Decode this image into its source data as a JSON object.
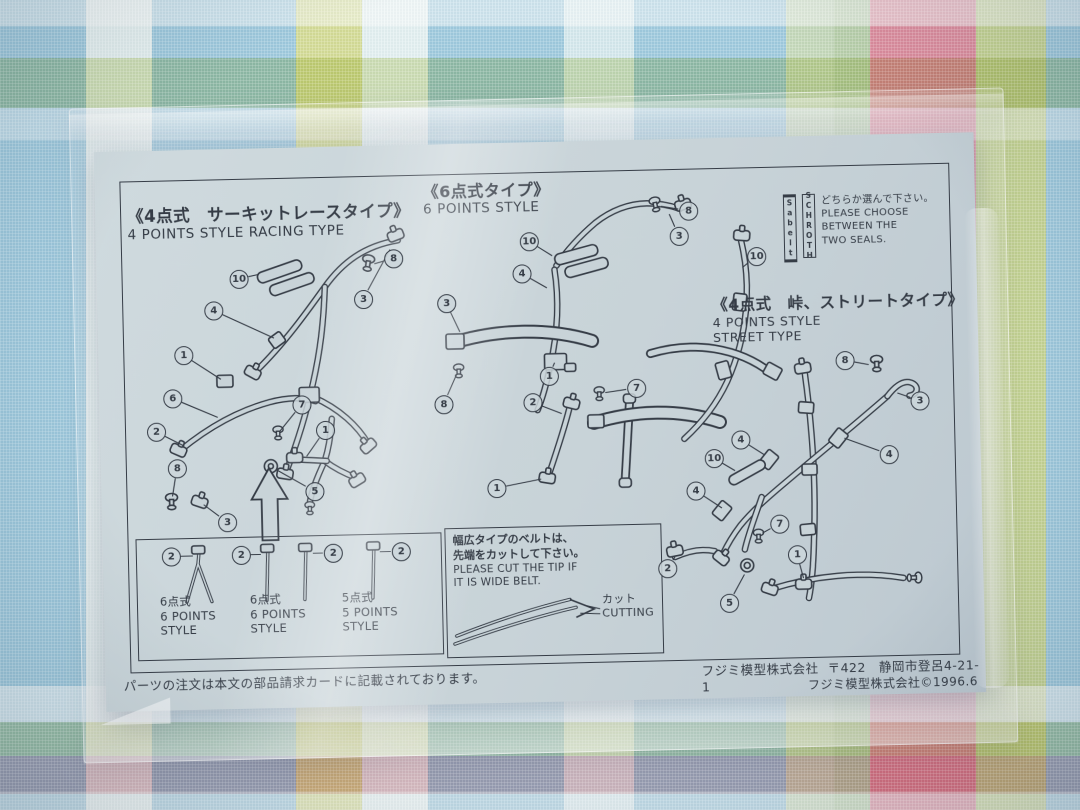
{
  "colors": {
    "fabric_blue": "#9fcade",
    "fabric_pink": "#ee8e9d",
    "fabric_yellow": "#e6df85",
    "fabric_green": "#cdd68e",
    "fabric_white": "#eef4f0",
    "paper": "#c8d3d8",
    "ink": "#353c46"
  },
  "sheet": {
    "sections": {
      "racing": {
        "title_jp": "《4点式　サーキットレースタイプ》",
        "title_en": "4 POINTS STYLE RACING TYPE"
      },
      "six_point": {
        "title_jp": "《6点式タイプ》",
        "title_en": "6 POINTS STYLE"
      },
      "street": {
        "title_jp": "《4点式　峠、ストリートタイプ》",
        "title_en_1": "4 POINTS STYLE",
        "title_en_2": "STREET TYPE"
      },
      "seal_choice": {
        "seal_1": "Sabelt",
        "seal_2": "SCHROTH",
        "jp": "どちらか選んで下さい。",
        "en_1": "PLEASE CHOOSE",
        "en_2": "BETWEEN THE",
        "en_3": "TWO SEALS."
      },
      "belt_ends_box": {
        "items": [
          {
            "jp": "6点式",
            "en_1": "6 POINTS",
            "en_2": "STYLE"
          },
          {
            "jp": "6点式",
            "en_1": "6 POINTS",
            "en_2": "STYLE"
          },
          {
            "jp": "5点式",
            "en_1": "5 POINTS",
            "en_2": "STYLE"
          }
        ]
      },
      "cutting_box": {
        "jp_1": "幅広タイプのベルトは、",
        "jp_2": "先端をカットして下さい。",
        "en_1": "PLEASE CUT THE TIP IF",
        "en_2": "IT IS WIDE BELT.",
        "cut_jp": "カット",
        "cut_en": "CUTTING"
      }
    },
    "footer": {
      "left": "パーツの注文は本文の部品請求カードに記載されております。",
      "company": "フジミ模型株式会社",
      "address": "〒422　静岡市登呂4-21-1",
      "copyright": "フジミ模型株式会社©1996.6"
    }
  },
  "callouts": [
    {
      "n": "10",
      "x": 142,
      "y": 130,
      "tx": 162,
      "ty": 126
    },
    {
      "n": "4",
      "x": 116,
      "y": 161,
      "tx": 176,
      "ty": 190
    },
    {
      "n": "1",
      "x": 85,
      "y": 205,
      "tx": 122,
      "ty": 230
    },
    {
      "n": "6",
      "x": 73,
      "y": 248,
      "tx": 118,
      "ty": 268
    },
    {
      "n": "8",
      "x": 297,
      "y": 113,
      "tx": 278,
      "ty": 118
    },
    {
      "n": "3",
      "x": 266,
      "y": 153,
      "tx": 294,
      "ty": 104
    },
    {
      "n": "2",
      "x": 56,
      "y": 281,
      "tx": 84,
      "ty": 296
    },
    {
      "n": "7",
      "x": 202,
      "y": 257,
      "tx": 180,
      "ty": 283
    },
    {
      "n": "8",
      "x": 76,
      "y": 318,
      "tx": 71,
      "ty": 346
    },
    {
      "n": "3",
      "x": 125,
      "y": 373,
      "tx": 102,
      "ty": 355
    },
    {
      "n": "5",
      "x": 213,
      "y": 344,
      "tx": 176,
      "ty": 322
    },
    {
      "n": "1",
      "x": 225,
      "y": 283,
      "tx": 206,
      "ty": 309
    },
    {
      "n": "10",
      "x": 433,
      "y": 99,
      "tx": 456,
      "ty": 114
    },
    {
      "n": "3",
      "x": 583,
      "y": 97,
      "tx": 574,
      "ty": 75
    },
    {
      "n": "8",
      "x": 593,
      "y": 72,
      "tx": 566,
      "ty": 67
    },
    {
      "n": "4",
      "x": 425,
      "y": 131,
      "tx": 450,
      "ty": 146
    },
    {
      "n": "3",
      "x": 349,
      "y": 159,
      "tx": 362,
      "ty": 188
    },
    {
      "n": "8",
      "x": 344,
      "y": 260,
      "tx": 358,
      "ty": 230
    },
    {
      "n": "1",
      "x": 450,
      "y": 234,
      "tx": 456,
      "ty": 221
    },
    {
      "n": "7",
      "x": 537,
      "y": 248,
      "tx": 506,
      "ty": 252
    },
    {
      "n": "2",
      "x": 433,
      "y": 260,
      "tx": 462,
      "ty": 272
    },
    {
      "n": "1",
      "x": 395,
      "y": 345,
      "tx": 440,
      "ty": 337
    },
    {
      "n": "10",
      "x": 660,
      "y": 119,
      "tx": 646,
      "ty": 130
    },
    {
      "n": "8",
      "x": 746,
      "y": 225,
      "tx": 770,
      "ty": 230
    },
    {
      "n": "3",
      "x": 820,
      "y": 267,
      "tx": 798,
      "ty": 259
    },
    {
      "n": "4",
      "x": 640,
      "y": 302,
      "tx": 664,
      "ty": 318
    },
    {
      "n": "4",
      "x": 788,
      "y": 320,
      "tx": 744,
      "ty": 303
    },
    {
      "n": "10",
      "x": 613,
      "y": 320,
      "tx": 634,
      "ty": 333
    },
    {
      "n": "4",
      "x": 594,
      "y": 352,
      "tx": 620,
      "ty": 370
    },
    {
      "n": "7",
      "x": 677,
      "y": 387,
      "tx": 660,
      "ty": 396
    },
    {
      "n": "2",
      "x": 564,
      "y": 429,
      "tx": 572,
      "ty": 418
    },
    {
      "n": "5",
      "x": 625,
      "y": 465,
      "tx": 641,
      "ty": 437
    },
    {
      "n": "1",
      "x": 694,
      "y": 418,
      "tx": 700,
      "ty": 442
    },
    {
      "n": "2",
      "x": 68,
      "y": 406,
      "tx": 90,
      "ty": 406
    },
    {
      "n": "2",
      "x": 138,
      "y": 406,
      "tx": 158,
      "ty": 406
    },
    {
      "n": "2",
      "x": 230,
      "y": 406,
      "tx": 210,
      "ty": 406
    },
    {
      "n": "2",
      "x": 298,
      "y": 406,
      "tx": 277,
      "ty": 406
    }
  ]
}
